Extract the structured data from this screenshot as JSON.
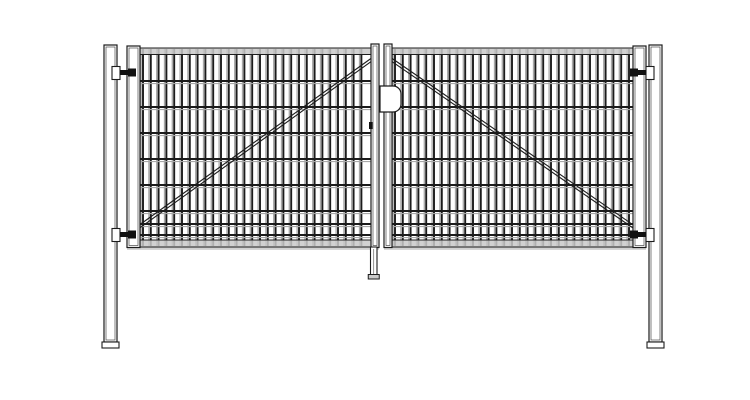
{
  "drawing": {
    "type": "technical-line-drawing",
    "subject": "double-leaf wire mesh gate, front elevation",
    "background": "#ffffff"
  },
  "colors": {
    "line": "#1c1c1c",
    "line_soft": "#4a4a4a",
    "wire_dark": "#1b1b1b",
    "wire_light": "#a8a8a8",
    "rail_fill": "#c9c9c9",
    "rail_shadow": "#bdbdbd",
    "fill_white": "#ffffff",
    "pin_dark": "#111111"
  },
  "layout": {
    "canvas_width": 750,
    "canvas_height": 400,
    "wire_top": 49,
    "wire_bottom": 246,
    "top_rail": {
      "y": 48,
      "height": 6.5
    },
    "bottom_rail": {
      "y": 240,
      "height": 7
    },
    "bottom_shadow": {
      "y": 247.5,
      "height": 2.4
    },
    "vertical_wire_spacing": 7.8,
    "horizontal_wires_y": [
      81,
      107,
      133,
      159,
      185,
      211,
      224,
      235
    ],
    "stile_top": 44,
    "stile_bottom": 247.5,
    "mirror_x": 383
  },
  "posts": [
    {
      "name": "left-post",
      "x": 104,
      "y": 45,
      "width": 13,
      "height": 297,
      "foot_height": 6,
      "foot_extra": 2
    },
    {
      "name": "right-post",
      "x": 649,
      "y": 45,
      "width": 13,
      "height": 297,
      "foot_height": 6,
      "foot_extra": 2
    }
  ],
  "leaves": [
    {
      "name": "left-leaf",
      "x1": 127,
      "x2": 379,
      "outer_stile": {
        "x": 127,
        "width": 13
      },
      "center_stile": {
        "x": 371,
        "width": 8
      },
      "mesh_from": 143,
      "mesh_to": 369,
      "brace": {
        "from": [
          373,
          57
        ],
        "to": [
          131,
          231
        ]
      }
    },
    {
      "name": "right-leaf",
      "x1": 384,
      "x2": 646,
      "outer_stile": {
        "x": 633,
        "width": 13
      },
      "center_stile": {
        "x": 384,
        "width": 8
      },
      "mesh_from": 395,
      "mesh_to": 631,
      "brace": {
        "from": [
          390,
          57
        ],
        "to": [
          642,
          231
        ]
      }
    }
  ],
  "brace_double_offset": 3.2,
  "hinges": [
    {
      "name": "hinge-top-left",
      "side": "left",
      "y": 66
    },
    {
      "name": "hinge-bottom-left",
      "side": "left",
      "y": 228
    },
    {
      "name": "hinge-top-right",
      "side": "right",
      "y": 66
    },
    {
      "name": "hinge-bottom-right",
      "side": "right",
      "y": 228
    }
  ],
  "hinge_geometry": {
    "bracket_x": 112,
    "bracket_w": 8,
    "bracket_h": 13,
    "pin_x": 120,
    "pin_w": 12,
    "pin_h": 5,
    "block_x": 128,
    "block_w": 8,
    "block_h": 8
  },
  "lock": {
    "plate": {
      "x": 380,
      "y": 86,
      "width": 21,
      "height": 26,
      "corner": 8
    },
    "keyhole": {
      "x": 369,
      "y": 122,
      "width": 3.5,
      "height": 7
    }
  },
  "drop_rod": {
    "x": 370.5,
    "y": 247,
    "width": 6.5,
    "height": 29,
    "foot_width": 11,
    "foot_height": 4.5
  }
}
